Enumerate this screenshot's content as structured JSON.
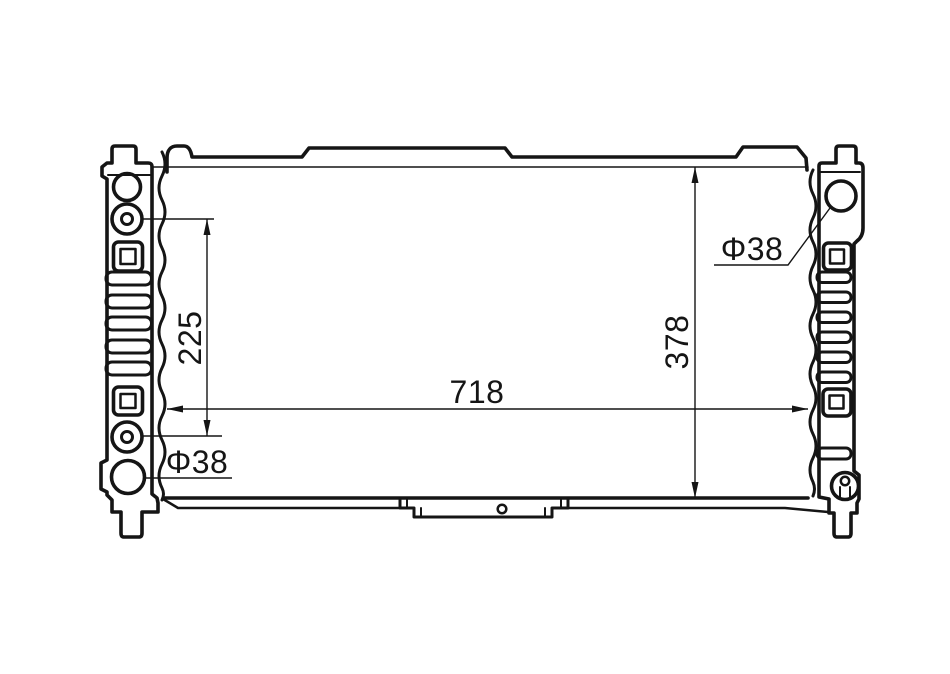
{
  "drawing": {
    "subject": "Radiator outline technical drawing, front view",
    "line_color": "#151515",
    "background_color": "#ffffff"
  },
  "labels": {
    "core_width": "718",
    "core_height": "378",
    "inlet_offset": "225",
    "inlet_diameter": "Φ38",
    "outlet_diameter": "Φ38"
  }
}
